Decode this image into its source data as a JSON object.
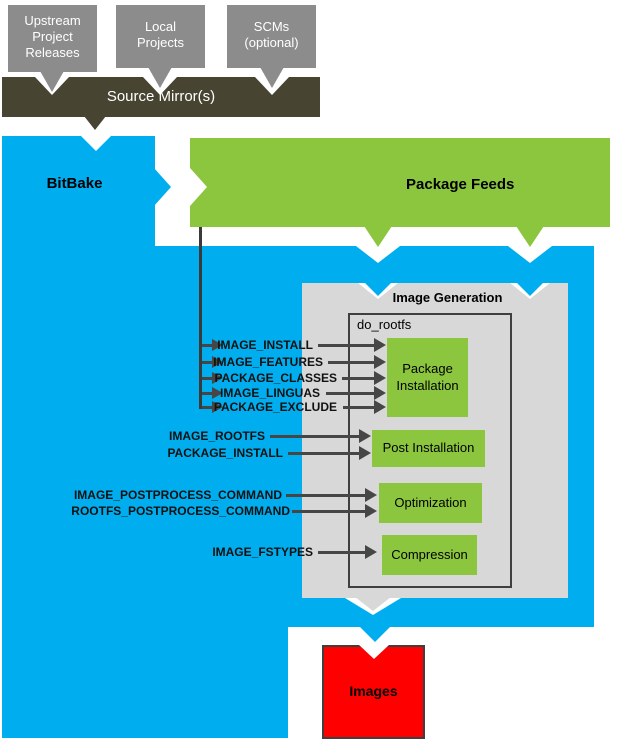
{
  "top": {
    "boxes": [
      {
        "label": "Upstream\nProject\nReleases"
      },
      {
        "label": "Local\nProjects"
      },
      {
        "label": "SCMs\n(optional)"
      }
    ],
    "source_mirror_label": "Source Mirror(s)"
  },
  "bitbake_label": "BitBake",
  "package_feeds_label": "Package Feeds",
  "image_generation": {
    "title": "Image Generation",
    "task_label": "do_rootfs",
    "steps": [
      {
        "label": "Package\nInstallation"
      },
      {
        "label": "Post Installation"
      },
      {
        "label": "Optimization"
      },
      {
        "label": "Compression"
      }
    ]
  },
  "variables": {
    "rows": [
      {
        "label": "IMAGE_INSTALL"
      },
      {
        "label": "IMAGE_FEATURES"
      },
      {
        "label": "PACKAGE_CLASSES"
      },
      {
        "label": "IMAGE_LINGUAS"
      },
      {
        "label": "PACKAGE_EXCLUDE"
      },
      {
        "label": "IMAGE_ROOTFS"
      },
      {
        "label": "PACKAGE_INSTALL"
      },
      {
        "label": "IMAGE_POSTPROCESS_COMMAND"
      },
      {
        "label": "ROOTFS_POSTPROCESS_COMMAND"
      },
      {
        "label": "IMAGE_FSTYPES"
      }
    ]
  },
  "images_box_label": "Images",
  "colors": {
    "blue": "#00AEEF",
    "green": "#8CC63F",
    "olive": "#474532",
    "top_gray": "#8C8C8C",
    "light_gray": "#D8D8D8",
    "red": "#FF0000",
    "arrow_gray": "#464646",
    "border_dark": "#3F3F3F"
  }
}
